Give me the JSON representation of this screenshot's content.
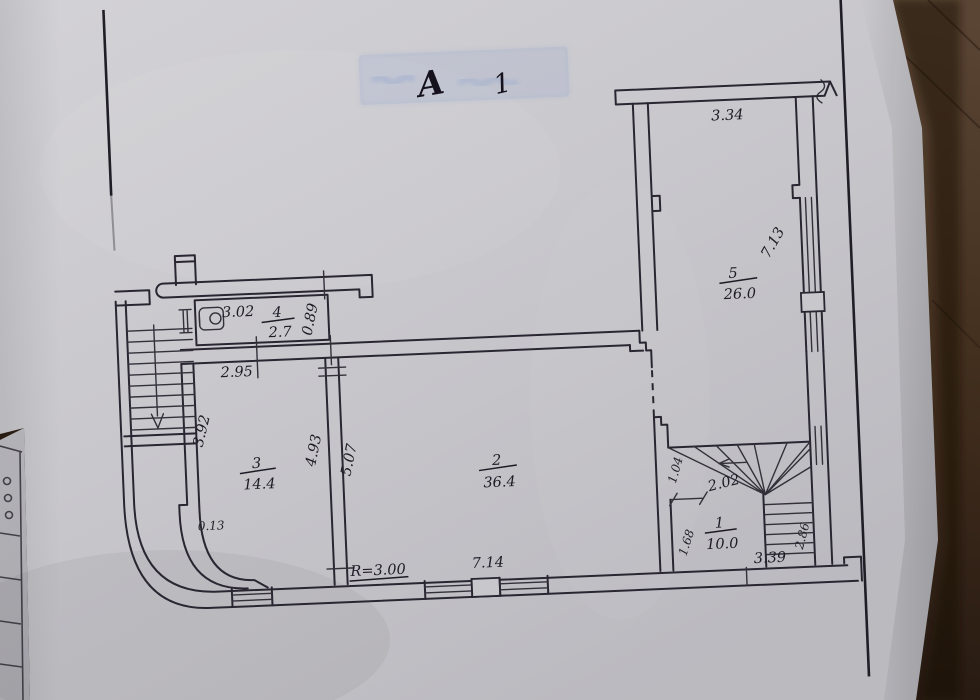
{
  "photo": {
    "description": "hand-drawn floor plan on grey paper photographed on dark wooden table",
    "colors": {
      "table_brown": "#4a3526",
      "paper_grey": "#cfced3",
      "second_sheet_grey": "#c5c4ca",
      "ink": "#2b2833",
      "stamp_blue": "#8aa4d6"
    }
  },
  "stamp": {
    "letter": "А",
    "mark": "1"
  },
  "plan": {
    "rooms": [
      {
        "number": "5",
        "area": "26.0"
      },
      {
        "number": "4",
        "area": "2.7"
      },
      {
        "number": "3",
        "area": "14.4"
      },
      {
        "number": "2",
        "area": "36.4"
      },
      {
        "number": "1",
        "area": "10.0"
      }
    ],
    "dims": {
      "d334": "3.34",
      "d713": "7.13",
      "d302": "3.02",
      "d089": "0.89",
      "d295": "2.95",
      "d392": "3.92",
      "d493": "4.93",
      "d507": "5.07",
      "d013": "0.13",
      "dr300": "R=3.00",
      "d714": "7.14",
      "d202": "2.02",
      "d104": "1.04",
      "d168": "1.68",
      "d286": "2.86",
      "d339": "3.39"
    }
  }
}
